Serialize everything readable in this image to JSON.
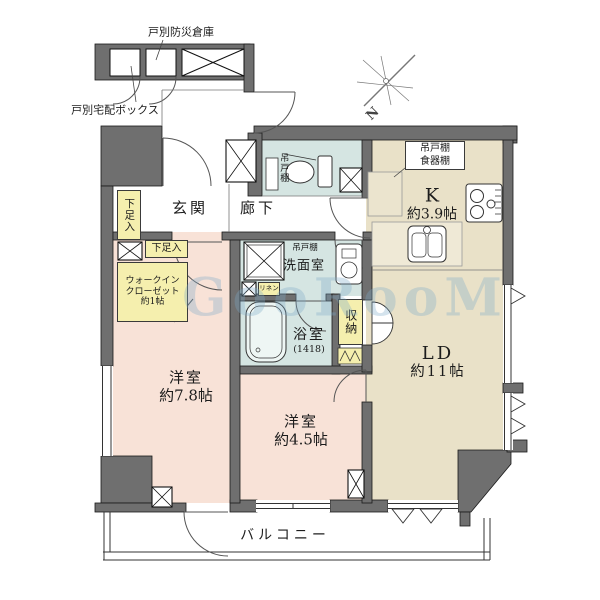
{
  "plan": {
    "watermark": "GooRooM",
    "compass_n": "N",
    "annex": {
      "disaster": "戸別防災倉庫",
      "delivery": "戸別宅配ボックス"
    },
    "entry": {
      "genkan": "玄関",
      "hallway": "廊下"
    },
    "kitchen": {
      "label": "K",
      "size": "約3.9帖",
      "cabinet_line1": "吊戸棚",
      "cabinet_line2": "食器棚"
    },
    "living": {
      "label": "LD",
      "size": "約11帖"
    },
    "bedroom_main": {
      "label": "洋室",
      "size": "約7.8帖"
    },
    "bedroom_second": {
      "label": "洋室",
      "size": "約4.5帖"
    },
    "sanitary": {
      "washroom": "洗面室",
      "washroom_cabinet": "吊戸棚",
      "bathroom": "浴室",
      "bathroom_size": "(1418)",
      "toilet_cabinet": "吊戸棚",
      "linen": "リネン"
    },
    "storage": {
      "shoe_left": "下足入",
      "shoe_front": "下足入",
      "wic_line1": "ウォークイン",
      "wic_line2": "クローゼット",
      "wic_line3": "約1帖",
      "closet": "収納"
    },
    "balcony": "バルコニー"
  }
}
